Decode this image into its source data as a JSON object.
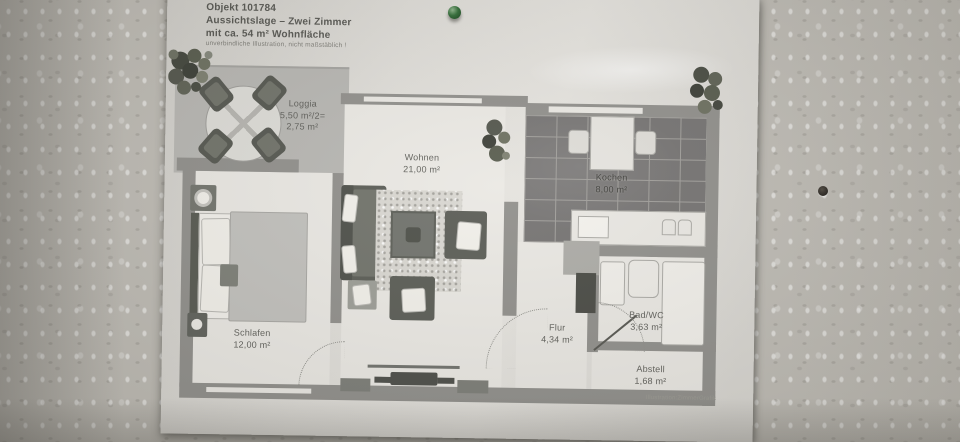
{
  "photo": {
    "credit": "Illustration:ZimmerGrafik",
    "colors": {
      "pushpin": "#2f6b35",
      "wall": "#bdbab3",
      "paper": "#dfddd8",
      "plan_walls": "#8f8e8a"
    }
  },
  "header": {
    "object_id": "Objekt 101784",
    "title": "Aussichtslage – Zwei Zimmer",
    "subtitle": "mit ca. 54 m² Wohnfläche",
    "disclaimer": "unverbindliche Illustration, nicht maßstäblich !"
  },
  "rooms": {
    "loggia": {
      "name": "Loggia",
      "area1": "5,50 m²/2=",
      "area2": "2,75 m²"
    },
    "wohnen": {
      "name": "Wohnen",
      "area": "21,00 m²"
    },
    "kochen": {
      "name": "Kochen",
      "area": "8,00 m²"
    },
    "schlafen": {
      "name": "Schlafen",
      "area": "12,00 m²"
    },
    "flur": {
      "name": "Flur",
      "area": "4,34 m²"
    },
    "bad": {
      "name": "Bad/WC",
      "area": "3,63 m²"
    },
    "abstell": {
      "name": "Abstell",
      "area": "1,68 m²"
    }
  }
}
